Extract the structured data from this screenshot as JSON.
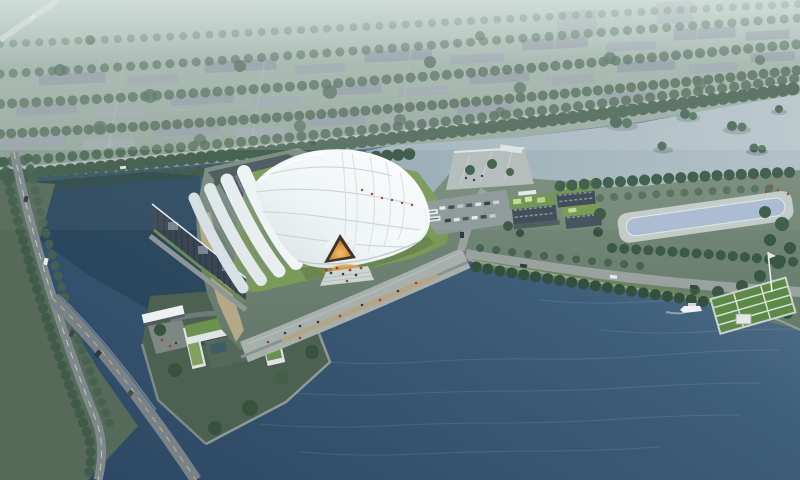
{
  "scene": {
    "type": "aerial-architectural-rendering",
    "title": "Lakeside exhibition hall — aerial dusk rendering",
    "description": "Bird's-eye rendering of a white membrane-roofed exhibition hall on a lake peninsula. Hazy city blocks and a tree-lined boulevard fill the top, a reflecting pool and green-roof buildings sit on the right bank, a U-shaped green-roof building and road bridge occupy the lower left, and a large rippled lake fills the lower right with a green deck pier and a small white boat."
  },
  "visible_features": [
    "hazy city blocks",
    "tree-lined boulevard",
    "upper water channel",
    "tree islands",
    "white membrane roof hall",
    "stepped vault roof bands",
    "dark glass facade",
    "glowing triangular entrance",
    "lawn apron",
    "waterfront promenade with people",
    "left pond and canal",
    "road bridge",
    "U-shaped green-roof building",
    "entrance gate canopy",
    "marina plaza",
    "parking lot with buses and cars",
    "green-roof building cluster",
    "reflecting pool",
    "tree rows",
    "green deck pier with mast",
    "white boat",
    "large lake"
  ],
  "palette": {
    "lake_deep": "#2a4560",
    "lake_mid": "#3f5e7a",
    "lake_light": "#6f8da3",
    "upper_water": "#93a8b2",
    "upper_water_light": "#b2c1c6",
    "city_top": "#a9bdb6",
    "city_bottom": "#879a8d",
    "building_block": "#8e99a3",
    "tree_dark": "#3c5847",
    "land_top": "#7a8e7e",
    "land_bottom": "#64786a",
    "lawn": "#7a9a58",
    "green_roof": "#6d9150",
    "deck_green": "#5c8946",
    "shell_white": "#ffffff",
    "shell_shade": "#d6dfe3",
    "facade": "#3a4653",
    "entrance_dark": "#3f332a",
    "glow_core": "#f7c061",
    "glow_edge": "#b5742a",
    "light_spill": "#d8a254",
    "pond": "#1f3a49",
    "pool": "#aabad2",
    "promenade": "#a8b0ad",
    "road": "#99a29f",
    "asphalt": "#77828a",
    "sand": "#bcab8b",
    "marina": "#b4bdbb",
    "parking": "#8d9797",
    "block_land": "#4d6153",
    "left_land": "#566a59",
    "boat_white": "#edf1f1",
    "car_light": "#e8eaea",
    "car_dark": "#39444b",
    "people_red": "#a93a2c",
    "people_dark": "#2e3944",
    "haze": "#eef6f3"
  }
}
